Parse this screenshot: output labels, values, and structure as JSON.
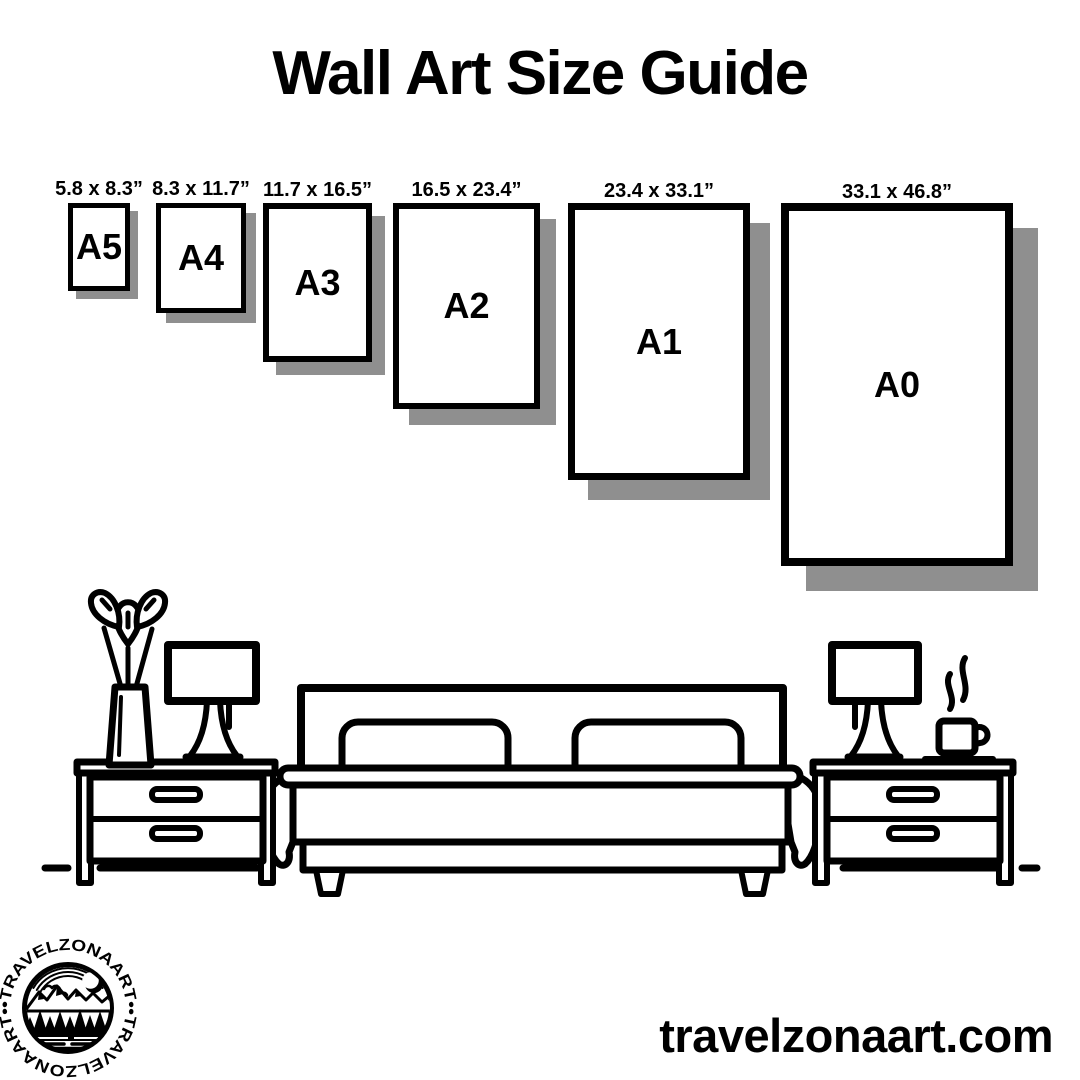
{
  "title": "Wall Art Size Guide",
  "size_guide": {
    "sizes": [
      {
        "code": "A5",
        "dims": "5.8 x 8.3”"
      },
      {
        "code": "A4",
        "dims": "8.3 x 11.7”"
      },
      {
        "code": "A3",
        "dims": "11.7 x 16.5”"
      },
      {
        "code": "A2",
        "dims": "16.5 x 23.4”"
      },
      {
        "code": "A1",
        "dims": "23.4 x 33.1”"
      },
      {
        "code": "A0",
        "dims": "33.1 x 46.8”"
      }
    ]
  },
  "logo": {
    "brand": "TRAVELZONAART",
    "ring_text": "•TRAVELZONAART••TRAVELZONAART•"
  },
  "footer": {
    "website": "travelzonaart.com"
  },
  "colors": {
    "ink": "#000000",
    "shadow": "#8f8f8f",
    "background": "#ffffff"
  }
}
